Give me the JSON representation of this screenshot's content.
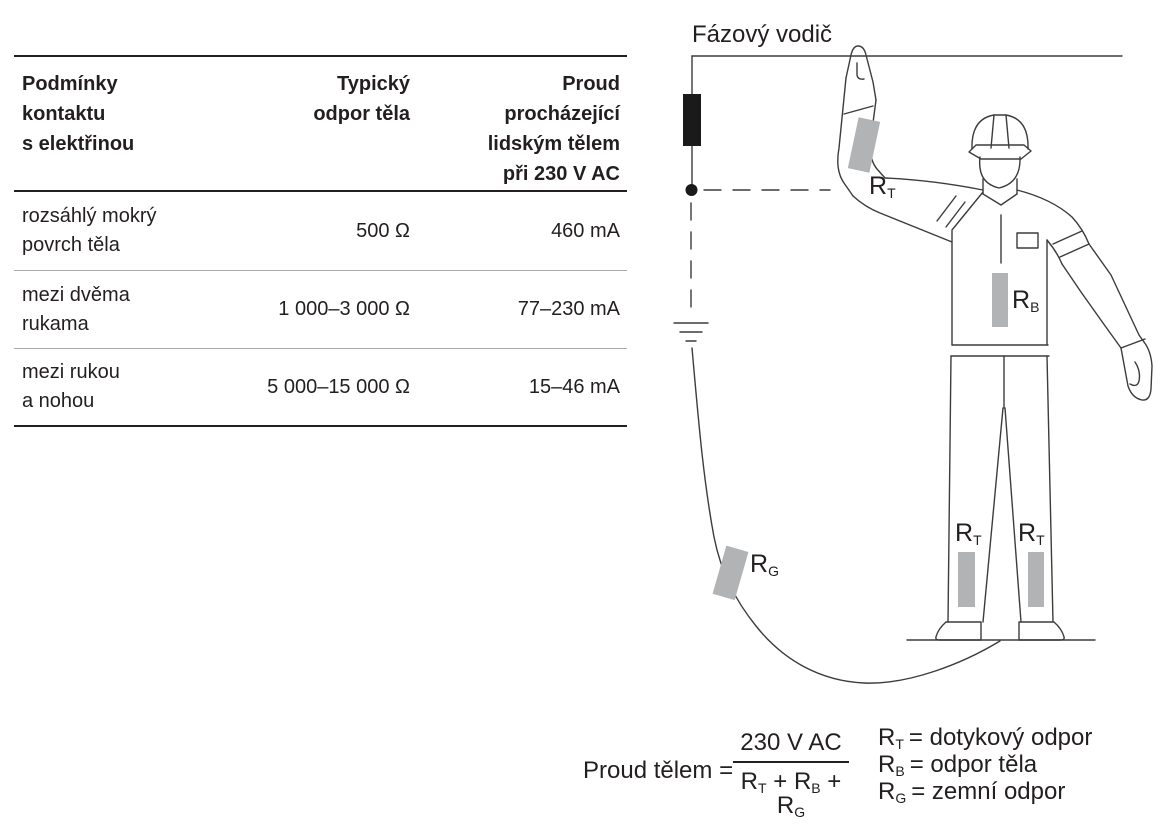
{
  "table": {
    "headers": {
      "col1": [
        "Podmínky",
        "kontaktu",
        "s elektřinou"
      ],
      "col2": [
        "Typický",
        "odpor těla"
      ],
      "col3": [
        "Proud",
        "procházející",
        "lidským tělem",
        "při 230 V AC"
      ]
    },
    "rows": [
      {
        "condition": [
          "rozsáhlý mokrý",
          "povrch těla"
        ],
        "resistance": "500 Ω",
        "current": "460 mA"
      },
      {
        "condition": [
          "mezi dvěma",
          "rukama"
        ],
        "resistance": "1 000–3 000 Ω",
        "current": "77–230 mA"
      },
      {
        "condition": [
          "mezi rukou",
          "a nohou"
        ],
        "resistance": "5 000–15 000 Ω",
        "current": "15–46 mA"
      }
    ]
  },
  "diagram": {
    "phase_label": "Fázový vodič",
    "rt": {
      "sym": "R",
      "sub": "T"
    },
    "rb": {
      "sym": "R",
      "sub": "B"
    },
    "rg": {
      "sym": "R",
      "sub": "G"
    }
  },
  "formula": {
    "lhs": "Proud tělem =",
    "numerator": "230 V AC",
    "plus": "+",
    "den": [
      {
        "sym": "R",
        "sub": "T"
      },
      {
        "sym": "R",
        "sub": "B"
      },
      {
        "sym": "R",
        "sub": "G"
      }
    ]
  },
  "legend": {
    "items": [
      {
        "sym": "R",
        "sub": "T",
        "def": "= dotykový odpor"
      },
      {
        "sym": "R",
        "sub": "B",
        "def": "= odpor těla"
      },
      {
        "sym": "R",
        "sub": "G",
        "def": "= zemní odpor"
      }
    ]
  },
  "colors": {
    "ink": "#231f20",
    "figure_line": "#3c3c3b",
    "gray_patch": "#b1b3b4",
    "rule_light": "#a7a9ac",
    "load_black": "#1a1a1a"
  }
}
